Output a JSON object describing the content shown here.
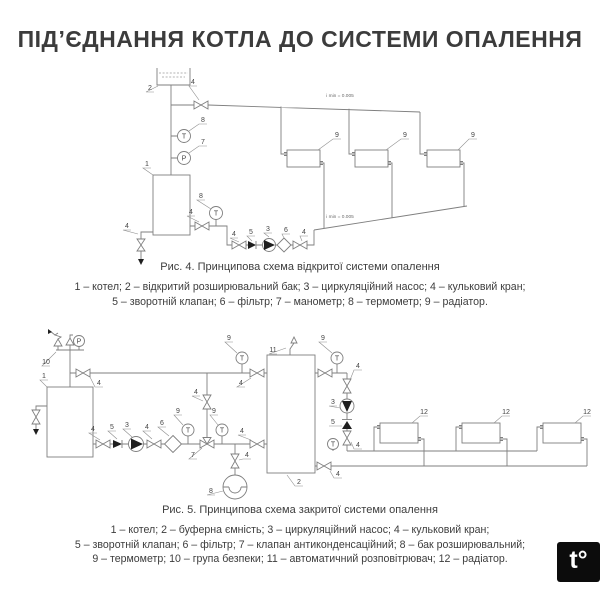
{
  "title": "ПІД’ЄДНАННЯ КОТЛА ДО СИСТЕМИ ОПАЛЕННЯ",
  "sym": {
    "t": "T",
    "p": "P"
  },
  "fig4": {
    "caption": "Рис. 4. Принципова схема відкритої системи опалення",
    "legend": [
      "1 – котел; 2 – відкритий розширювальний бак; 3 – циркуляційний насос; 4 – кульковий кран;",
      "5 – зворотній клапан; 6 – фільтр; 7 – манометр; 8 – термометр; 9 – радіатор."
    ],
    "slope_label": "i min = 0.005",
    "parts": {
      "boiler": "1",
      "expansion_tank": "2",
      "pump": "3",
      "ball_valve": "4",
      "check_valve": "5",
      "filter": "6",
      "manometer": "7",
      "thermometer": "8",
      "radiator": "9"
    }
  },
  "fig5": {
    "caption": "Рис. 5. Принципова схема закритої системи опалення",
    "legend": [
      "1 – котел; 2 – буферна ємність; 3 – циркуляційний насос; 4 – кульковий кран;",
      "5 – зворотній клапан; 6 – фільтр; 7 – клапан антиконденсаційний; 8 – бак розширювальний;",
      "9 – термометр; 10 – група безпеки; 11 – автоматичний розповітрювач; 12 – радіатор."
    ],
    "parts": {
      "boiler": "1",
      "buffer_tank": "2",
      "pump": "3",
      "ball_valve": "4",
      "check_valve": "5",
      "filter": "6",
      "anticondensation_valve": "7",
      "expansion_tank": "8",
      "thermometer": "9",
      "safety_group": "10",
      "air_vent": "11",
      "radiator": "12"
    }
  },
  "logo": {
    "text": "t°"
  }
}
